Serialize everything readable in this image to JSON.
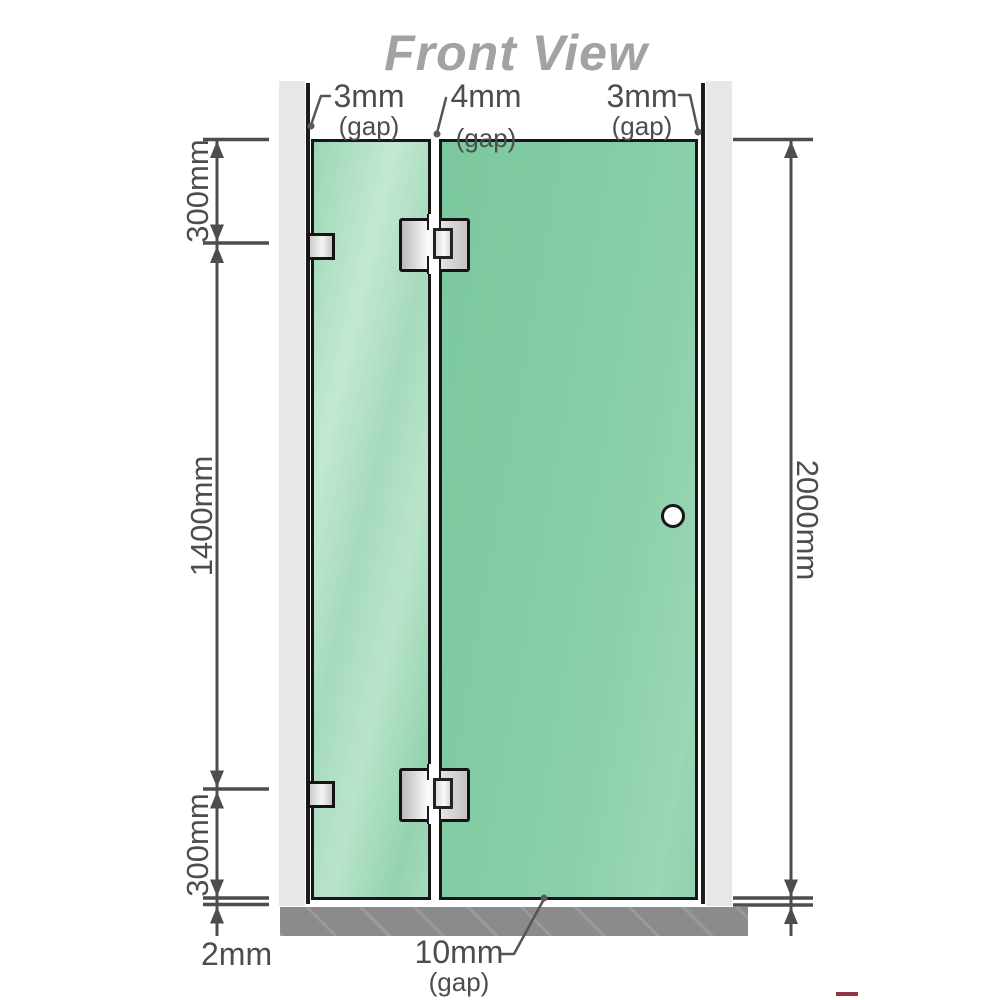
{
  "title": "Front View",
  "labels": {
    "gap_top_left": {
      "value": "3mm",
      "suffix": "(gap)"
    },
    "gap_top_middle": {
      "value": "4mm",
      "suffix": "(gap)"
    },
    "gap_top_right": {
      "value": "3mm",
      "suffix": "(gap)"
    },
    "gap_bottom": {
      "value": "10mm",
      "suffix": "(gap)"
    },
    "gap_floor": {
      "value": "2mm"
    }
  },
  "dimensions": {
    "left_top": "300mm",
    "left_middle": "1400mm",
    "left_bottom": "300mm",
    "right_full": "2000mm"
  },
  "colors": {
    "glass_fixed_panel": "#a6dabd",
    "glass_door_panel": "#83cca4",
    "wall": "#e7e7e7",
    "floor": "#8b8b8b",
    "dimension_lines": "#4d4d4d",
    "title_text": "#a2a2a2"
  }
}
